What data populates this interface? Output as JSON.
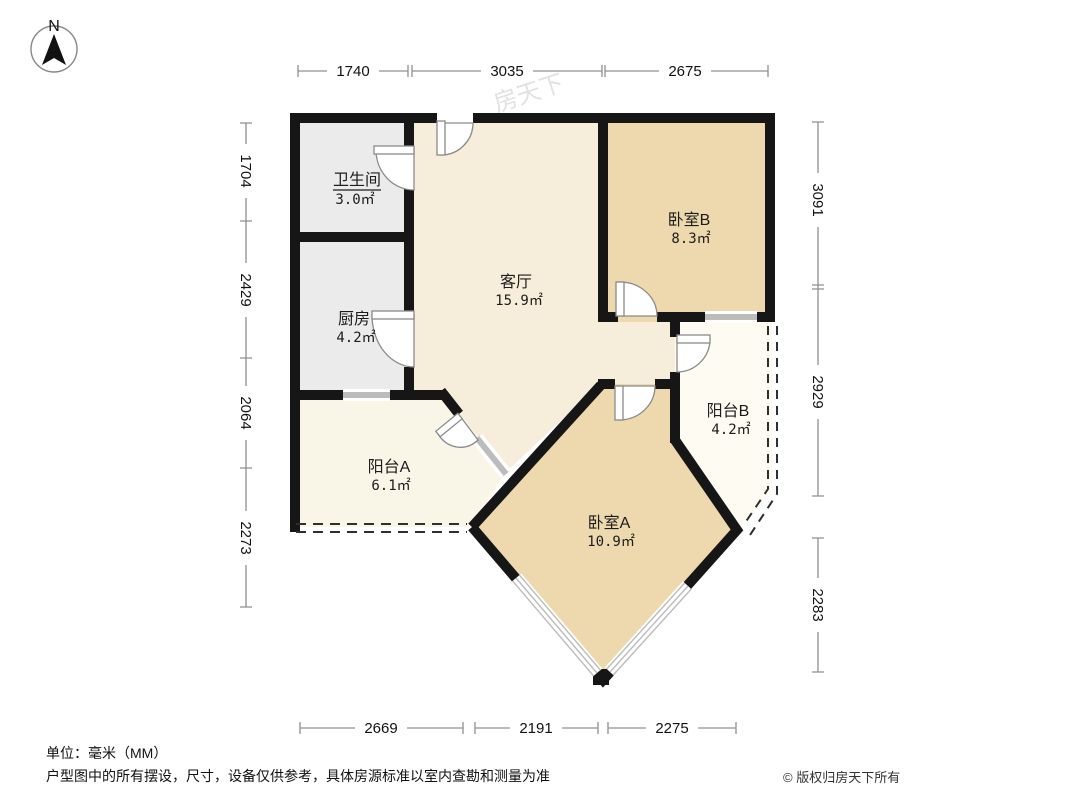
{
  "meta": {
    "compass_label": "N",
    "watermark": "房天下"
  },
  "colors": {
    "wall": "#161616",
    "living": "#f6eddb",
    "bedroom": "#edd9ad",
    "service": "#ebebeb",
    "balcony_a": "#faf6e7",
    "balcony_b": "#fdfbf2",
    "window": "#bcbcbc",
    "dashed": "#2f2f2f",
    "dim_line": "#909090",
    "dim_text": "#111111",
    "label_text": "#1c1c1c",
    "watermark": "#c9c9c9"
  },
  "rooms": {
    "bathroom": {
      "name": "卫生间",
      "area": "3.0㎡"
    },
    "kitchen": {
      "name": "厨房",
      "area": "4.2㎡"
    },
    "living": {
      "name": "客厅",
      "area": "15.9㎡"
    },
    "bedroom_b": {
      "name": "卧室B",
      "area": "8.3㎡"
    },
    "balcony_b": {
      "name": "阳台B",
      "area": "4.2㎡"
    },
    "balcony_a": {
      "name": "阳台A",
      "area": "6.1㎡"
    },
    "bedroom_a": {
      "name": "卧室A",
      "area": "10.9㎡"
    }
  },
  "dimensions": {
    "top": [
      "1740",
      "3035",
      "2675"
    ],
    "left": [
      "1704",
      "2429",
      "2064",
      "2273"
    ],
    "right": [
      "3091",
      "2929",
      "2283"
    ],
    "bottom": [
      "2669",
      "2191",
      "2275"
    ]
  },
  "footer": {
    "unit": "单位：毫米（MM）",
    "disclaimer": "户型图中的所有摆设，尺寸，设备仅供参考，具体房源标准以室内查勘和测量为准",
    "copyright": "© 版权归房天下所有"
  }
}
